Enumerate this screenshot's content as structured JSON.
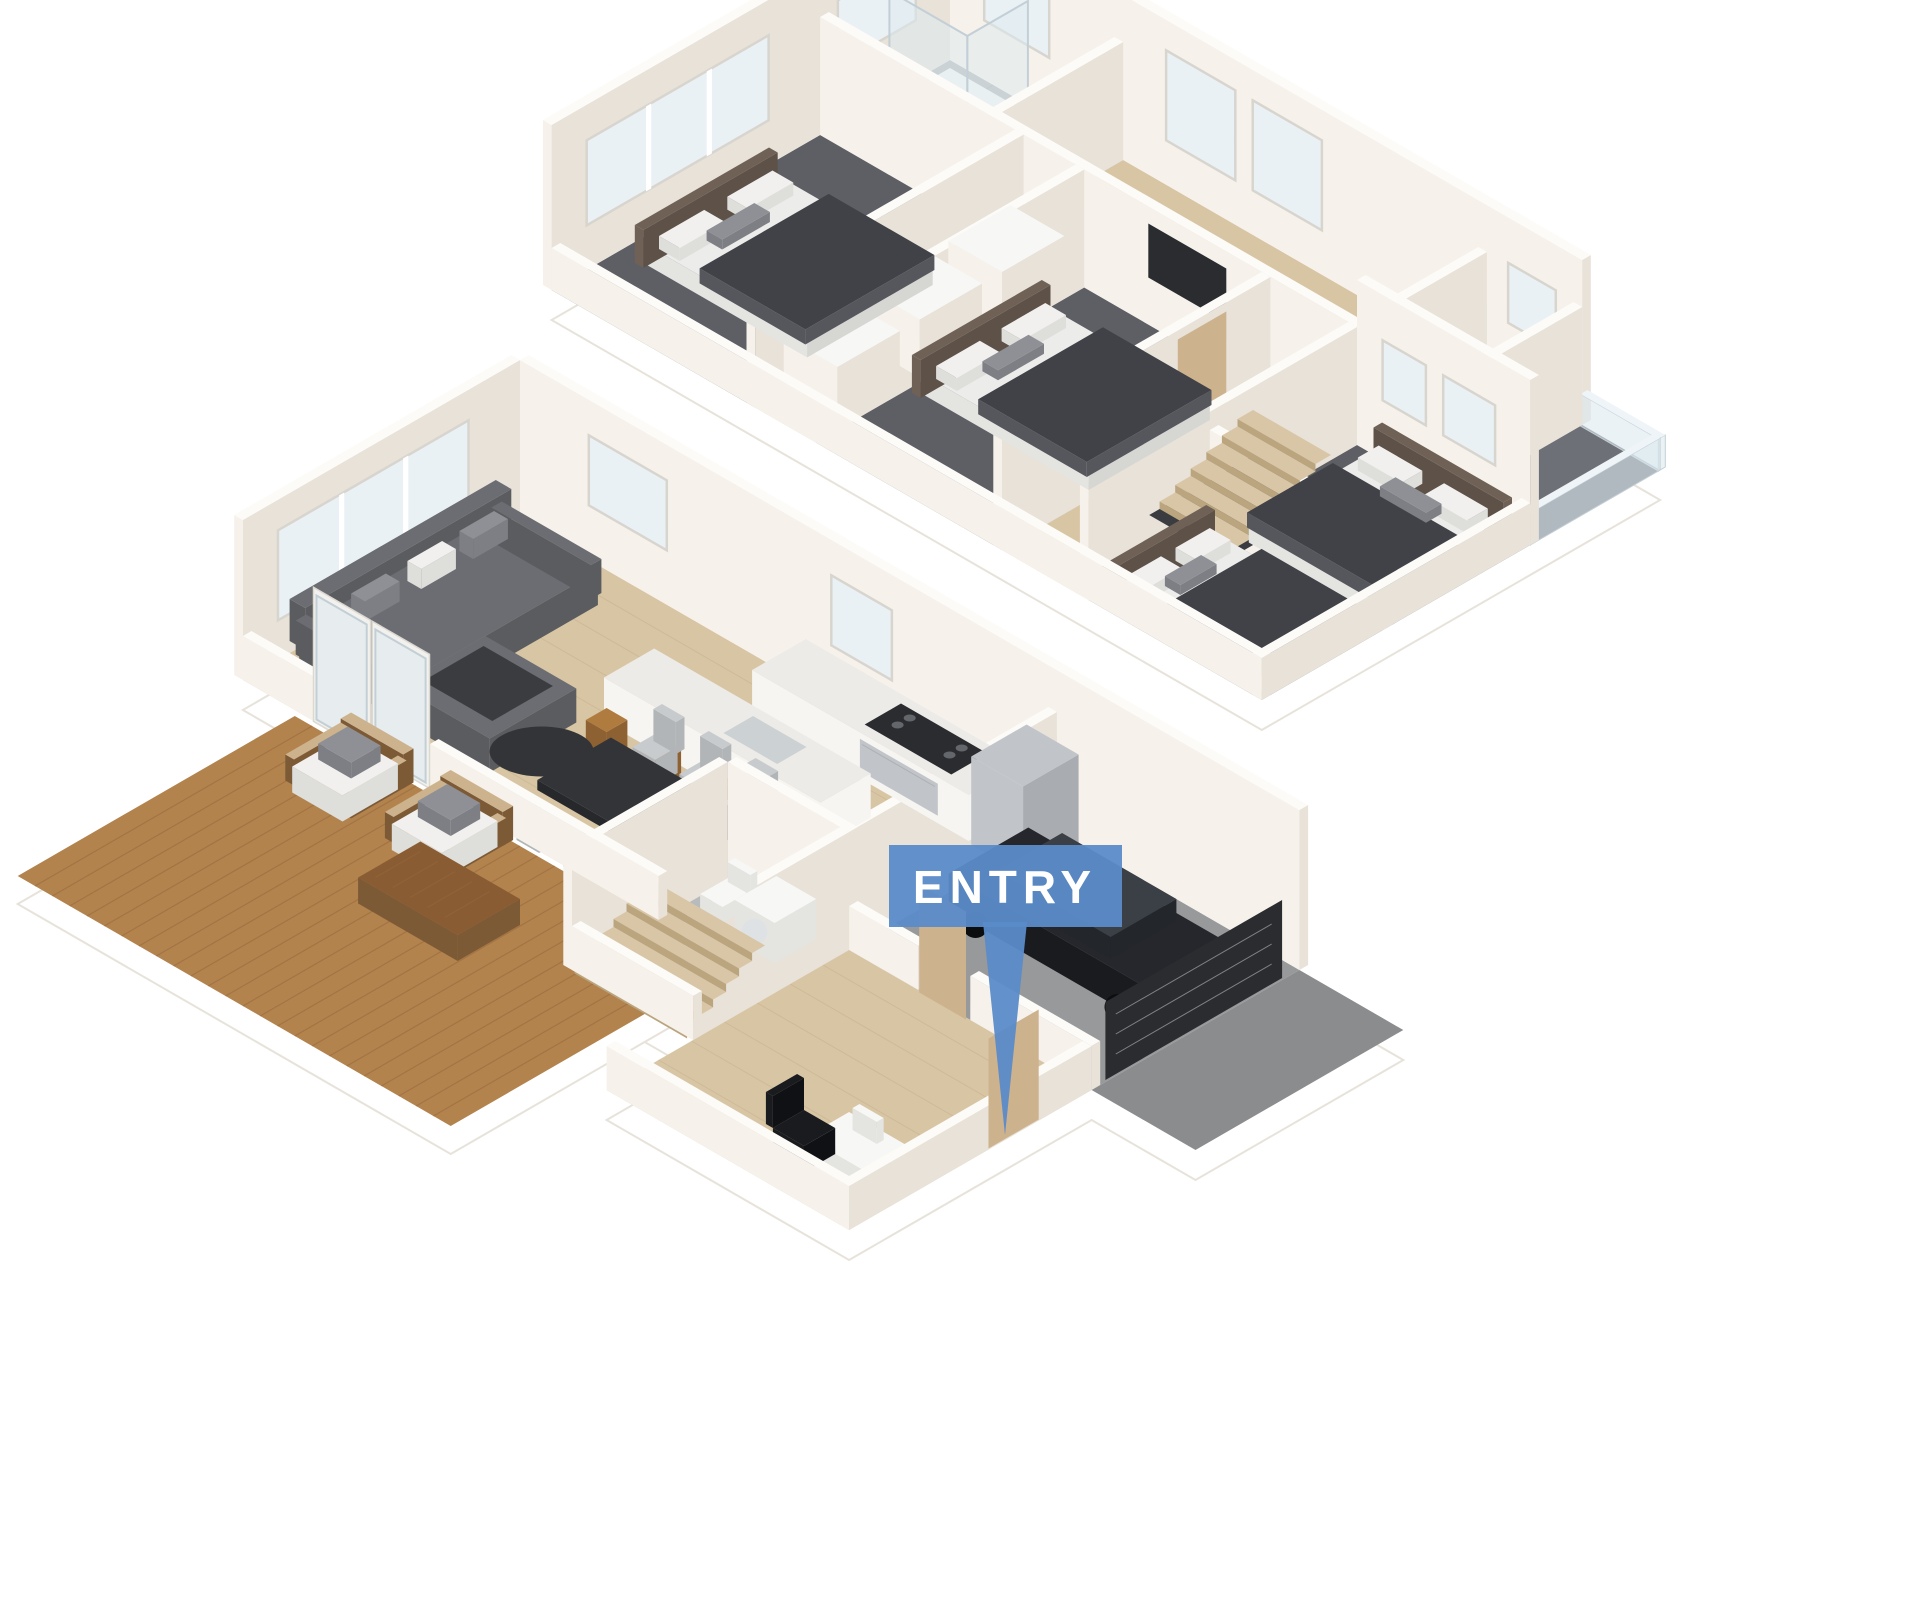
{
  "callout": {
    "label": "ENTRY"
  },
  "palette": {
    "page-bg": "#ffffff",
    "entry-blue": "#5b8bc9",
    "entry-text": "#ffffff",
    "wall-light": "#f6f2eb",
    "wall-shade": "#e8e2d8",
    "wall-top": "#fcfbf8",
    "slab-edge": "#e7e3db",
    "wood": "#d8c5a4",
    "wood-line": "#c3ac87",
    "carpet": "#5e5f65",
    "tile": "#b8bbbd",
    "tile-line": "#a5a8aa",
    "deck": "#b3834e",
    "deck-line": "#96683a",
    "concrete": "#98999b",
    "apron": "#8b8c8e",
    "marble": "#edebe7",
    "marble-side": "#f6f5f2",
    "stainless": "#c1c5c9",
    "sofa": "#5a5c60",
    "sofa-top": "#6b6d72",
    "pillow-white": "#f1f0ee",
    "pillow-gray": "#8e9095",
    "bed-dark": "#404247",
    "bed-mid": "#55575c",
    "mattress": "#ececeb",
    "headboard": "#6f6156",
    "table-dark": "#323438",
    "chair-gray": "#c8cbcd",
    "stool-wood": "#b07b3e",
    "car-body": "#1a1b1f",
    "car-glass": "#3a4046",
    "door-wood": "#cdb28e",
    "glass": "#dce9f0",
    "win": "#eaf1f5",
    "frame": "#d8d5cf",
    "dark-panel": "#2a2c30",
    "white": "#ffffff"
  }
}
